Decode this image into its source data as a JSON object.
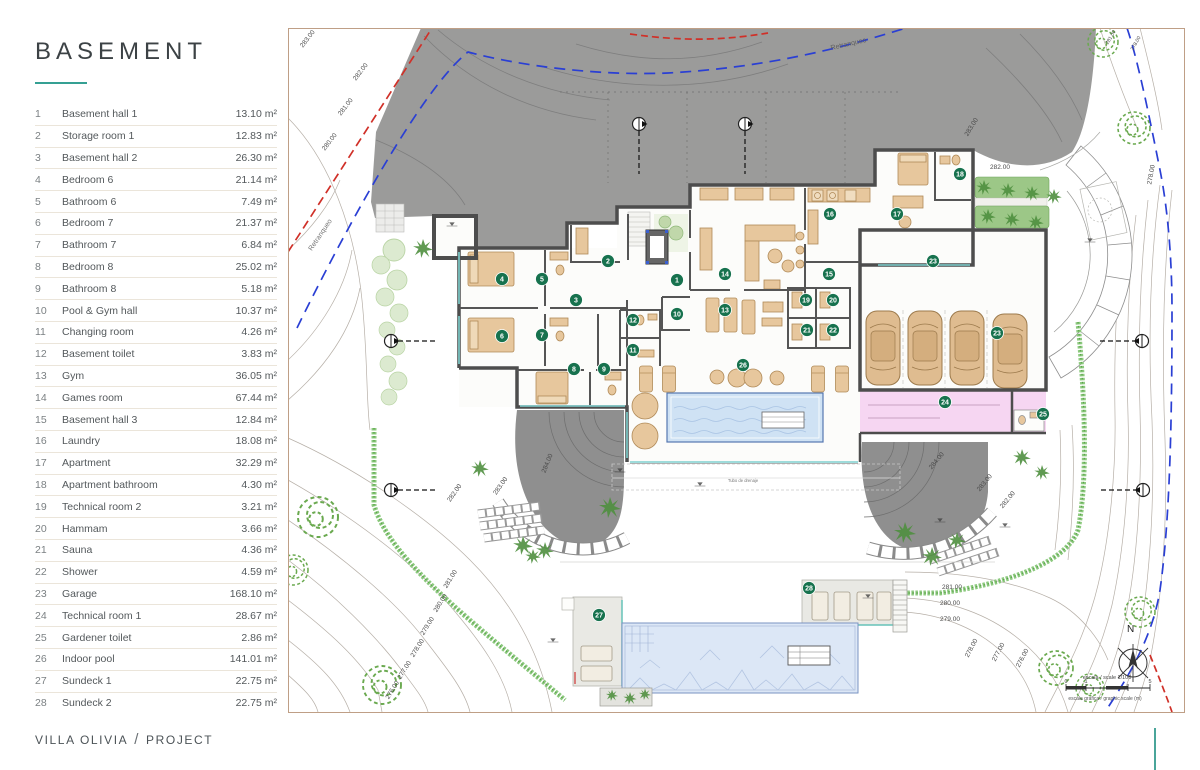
{
  "sidebar": {
    "title": "BASEMENT",
    "rooms": [
      {
        "num": "1",
        "name": "Basement hall 1",
        "area": "13.10 m²"
      },
      {
        "num": "2",
        "name": "Storage room 1",
        "area": "12.83 m²"
      },
      {
        "num": "3",
        "name": "Basement hall 2",
        "area": "26.30 m²"
      },
      {
        "num": "4",
        "name": "Bedroom 6",
        "area": "21.14 m²"
      },
      {
        "num": "5",
        "name": "Bathroom 6",
        "area": "7.49 m²"
      },
      {
        "num": "6",
        "name": "Bedroom 7",
        "area": "21.37 m²"
      },
      {
        "num": "7",
        "name": "Bathroom 7",
        "area": "6.84 m²"
      },
      {
        "num": "8",
        "name": "Bedroom 8",
        "area": "25.02 m²"
      },
      {
        "num": "9",
        "name": "Bathroom 8",
        "area": "5.18 m²"
      },
      {
        "num": "10",
        "name": "Pool & Gym hall",
        "area": "10.37 m²"
      },
      {
        "num": "11",
        "name": "Changing room",
        "area": "4.26 m²"
      },
      {
        "num": "12",
        "name": "Basement toilet",
        "area": "3.83 m²"
      },
      {
        "num": "13",
        "name": "Gym",
        "area": "36.05 m²"
      },
      {
        "num": "14",
        "name": "Games room",
        "area": "67.44 m²"
      },
      {
        "num": "15",
        "name": "Basement hall 3",
        "area": "12.84 m²"
      },
      {
        "num": "16",
        "name": "Laundry",
        "area": "18.08 m²"
      },
      {
        "num": "17",
        "name": "Apartment",
        "area": "32.29 m²"
      },
      {
        "num": "18",
        "name": "Apartment bathroom",
        "area": "4.30 m²"
      },
      {
        "num": "19",
        "name": "Technical room 2",
        "area": "3.21 m²"
      },
      {
        "num": "20",
        "name": "Hammam",
        "area": "3.66 m²"
      },
      {
        "num": "21",
        "name": "Sauna",
        "area": "4.36 m²"
      },
      {
        "num": "22",
        "name": "Shower",
        "area": "4.59 m²"
      },
      {
        "num": "23",
        "name": "Garage",
        "area": "168.10 m²"
      },
      {
        "num": "24",
        "name": "Technical room 1",
        "area": "28.67 m²"
      },
      {
        "num": "25",
        "name": "Gardener toilet",
        "area": "2.86 m²"
      },
      {
        "num": "26",
        "name": "Indoor pool",
        "area": "141.01 m²"
      },
      {
        "num": "27",
        "name": "Sundeck 1",
        "area": "22.75 m²"
      },
      {
        "num": "28",
        "name": "Sundeck 2",
        "area": "22.75 m²"
      }
    ]
  },
  "footer": {
    "project": "VILLA OLIVIA",
    "separator": "/",
    "section": "PROJECT"
  },
  "plan": {
    "badges": [
      {
        "n": "1",
        "x": 677,
        "y": 280
      },
      {
        "n": "2",
        "x": 608,
        "y": 261
      },
      {
        "n": "3",
        "x": 576,
        "y": 300
      },
      {
        "n": "4",
        "x": 502,
        "y": 279
      },
      {
        "n": "5",
        "x": 542,
        "y": 279
      },
      {
        "n": "6",
        "x": 502,
        "y": 336
      },
      {
        "n": "7",
        "x": 542,
        "y": 335
      },
      {
        "n": "8",
        "x": 574,
        "y": 369
      },
      {
        "n": "9",
        "x": 604,
        "y": 369
      },
      {
        "n": "10",
        "x": 677,
        "y": 314
      },
      {
        "n": "11",
        "x": 633,
        "y": 350
      },
      {
        "n": "12",
        "x": 633,
        "y": 320
      },
      {
        "n": "13",
        "x": 725,
        "y": 310
      },
      {
        "n": "14",
        "x": 725,
        "y": 274
      },
      {
        "n": "15",
        "x": 829,
        "y": 274
      },
      {
        "n": "16",
        "x": 830,
        "y": 214
      },
      {
        "n": "17",
        "x": 897,
        "y": 214
      },
      {
        "n": "18",
        "x": 960,
        "y": 174
      },
      {
        "n": "19",
        "x": 806,
        "y": 300
      },
      {
        "n": "20",
        "x": 833,
        "y": 300
      },
      {
        "n": "21",
        "x": 807,
        "y": 330
      },
      {
        "n": "22",
        "x": 833,
        "y": 330
      },
      {
        "n": "23",
        "x": 933,
        "y": 261
      },
      {
        "n": "23",
        "x": 997,
        "y": 333
      },
      {
        "n": "24",
        "x": 945,
        "y": 402
      },
      {
        "n": "25",
        "x": 1043,
        "y": 414
      },
      {
        "n": "26",
        "x": 743,
        "y": 365
      },
      {
        "n": "27",
        "x": 599,
        "y": 615
      },
      {
        "n": "28",
        "x": 809,
        "y": 588
      }
    ],
    "contour_labels": [
      {
        "t": "283.00",
        "x": 309,
        "y": 40,
        "r": -52
      },
      {
        "t": "282.00",
        "x": 362,
        "y": 73,
        "r": -52
      },
      {
        "t": "281.00",
        "x": 347,
        "y": 108,
        "r": -52
      },
      {
        "t": "280.00",
        "x": 331,
        "y": 143,
        "r": -52
      },
      {
        "t": "279.00",
        "x": 281,
        "y": 200,
        "r": -52
      },
      {
        "t": "283.00",
        "x": 973,
        "y": 128,
        "r": -58
      },
      {
        "t": "282.00",
        "x": 1000,
        "y": 169,
        "r": 0
      },
      {
        "t": "278.00",
        "x": 1153,
        "y": 175,
        "r": -80
      },
      {
        "t": "281.00",
        "x": 1112,
        "y": 38,
        "r": -60,
        "fs": 5
      },
      {
        "t": "278.00",
        "x": 1137,
        "y": 44,
        "r": -60,
        "fs": 5
      },
      {
        "t": "284.00",
        "x": 549,
        "y": 464,
        "r": -68
      },
      {
        "t": "283.00",
        "x": 502,
        "y": 487,
        "r": -55
      },
      {
        "t": "282.00",
        "x": 456,
        "y": 494,
        "r": -55
      },
      {
        "t": "284.00",
        "x": 938,
        "y": 462,
        "r": -50
      },
      {
        "t": "283.00",
        "x": 986,
        "y": 484,
        "r": -50
      },
      {
        "t": "282.00",
        "x": 1009,
        "y": 501,
        "r": -50
      },
      {
        "t": "281.00",
        "x": 452,
        "y": 580,
        "r": -58
      },
      {
        "t": "280.00",
        "x": 442,
        "y": 604,
        "r": -58
      },
      {
        "t": "279.00",
        "x": 429,
        "y": 627,
        "r": -58
      },
      {
        "t": "278.00",
        "x": 419,
        "y": 649,
        "r": -58
      },
      {
        "t": "277.00",
        "x": 406,
        "y": 671,
        "r": -58
      },
      {
        "t": "276.00",
        "x": 394,
        "y": 691,
        "r": -58
      },
      {
        "t": "281.00",
        "x": 952,
        "y": 589,
        "r": 0
      },
      {
        "t": "280.00",
        "x": 950,
        "y": 605,
        "r": 0
      },
      {
        "t": "279.00",
        "x": 950,
        "y": 621,
        "r": 0
      },
      {
        "t": "278.00",
        "x": 973,
        "y": 649,
        "r": -62
      },
      {
        "t": "277.00",
        "x": 1000,
        "y": 653,
        "r": -62
      },
      {
        "t": "276.00",
        "x": 1024,
        "y": 659,
        "r": -62
      }
    ],
    "annotations": {
      "retranqueo_left": "Retranqueo",
      "retranqueo_top": "Retranqueo",
      "north": "N",
      "scale_text": "escala / scale 1/100",
      "graphic_scale_text": "escala gráfica / graphic scale (m)",
      "tick0": "0",
      "tick1": "1",
      "tick5": "5",
      "drain_text": "Tubo de drenaje"
    },
    "colors": {
      "badge": "#17724e",
      "accent_teal": "#35a093",
      "driveway": "#9b9b9a",
      "wall": "#4d4d4d",
      "furniture": "#e7c79d",
      "indoor_pool": "#cfe2f4",
      "outdoor_pool": "#dce7f6",
      "pink_room": "#f6d6f2",
      "hedge": "#7dbb6d",
      "setback_blue": "#2a3fd4",
      "boundary_red": "#d03028"
    }
  }
}
